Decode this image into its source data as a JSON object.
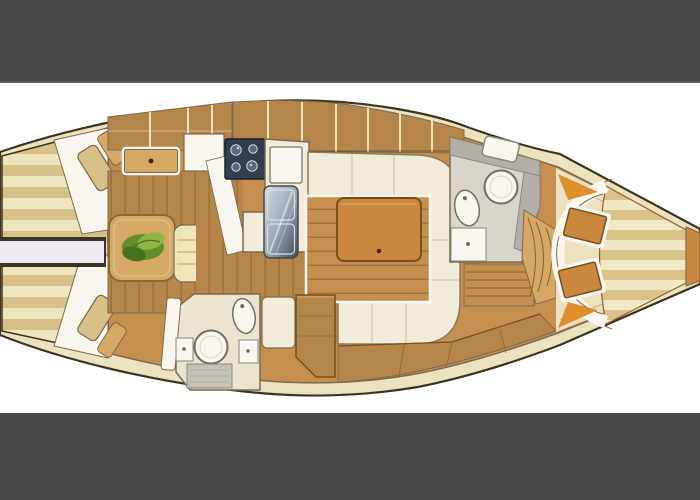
{
  "scene": {
    "kind": "yacht-interior-floor-plan",
    "orientation": "bow-left-stern-right",
    "visible_text": "none",
    "letterboxed": true
  },
  "palette": {
    "bar": "#474645",
    "bar_edge": "#5c5b59",
    "bg": "#ffffff",
    "hull_outline": "#3d3424",
    "deck_cream": "#ece2c0",
    "wood_base": "#c68f4e",
    "wood_cabinet": "#b5854a",
    "wood_light": "#d7a864",
    "wood_mid": "#8a6a3a",
    "floor_seam": "#8a5f2e",
    "mattress_light": "#efe5bd",
    "mattress_tan": "#d6c187",
    "cushion_cream": "#f1ecd9",
    "cushion_edge": "#8a7a5c",
    "white_trim": "#f8f6ee",
    "table_wood": "#c9883e",
    "table_edge": "#7a4e20",
    "knob_dark": "#4a2410",
    "stove_navy": "#333f4d",
    "stove_edge": "#16222d",
    "stove_burner": "#56687a",
    "steel": "#9aa8b4",
    "steel_light": "#d7dee4",
    "steel_dark": "#3f4a52",
    "gray_counter": "#b2afa8",
    "gray_outline": "#8a887c",
    "gray_light": "#d9d5cb",
    "gray_shower": "#c3c0b8",
    "fixture_gray": "#6f6f63",
    "fixture_inner": "#d5d5c8",
    "dot_gray": "#6b6b5a",
    "head_cream": "#e9e3cf",
    "plant_green": "#5f8f2f",
    "plant_green_light": "#8fb545",
    "plant_green_dark": "#48701f",
    "orange_accent": "#dd8f2e",
    "lavender": "#eeeaf2",
    "outline_soft": "#7a6a4e",
    "cockpit_light": "#f0e7c4",
    "cockpit_tan": "#d9c488"
  }
}
